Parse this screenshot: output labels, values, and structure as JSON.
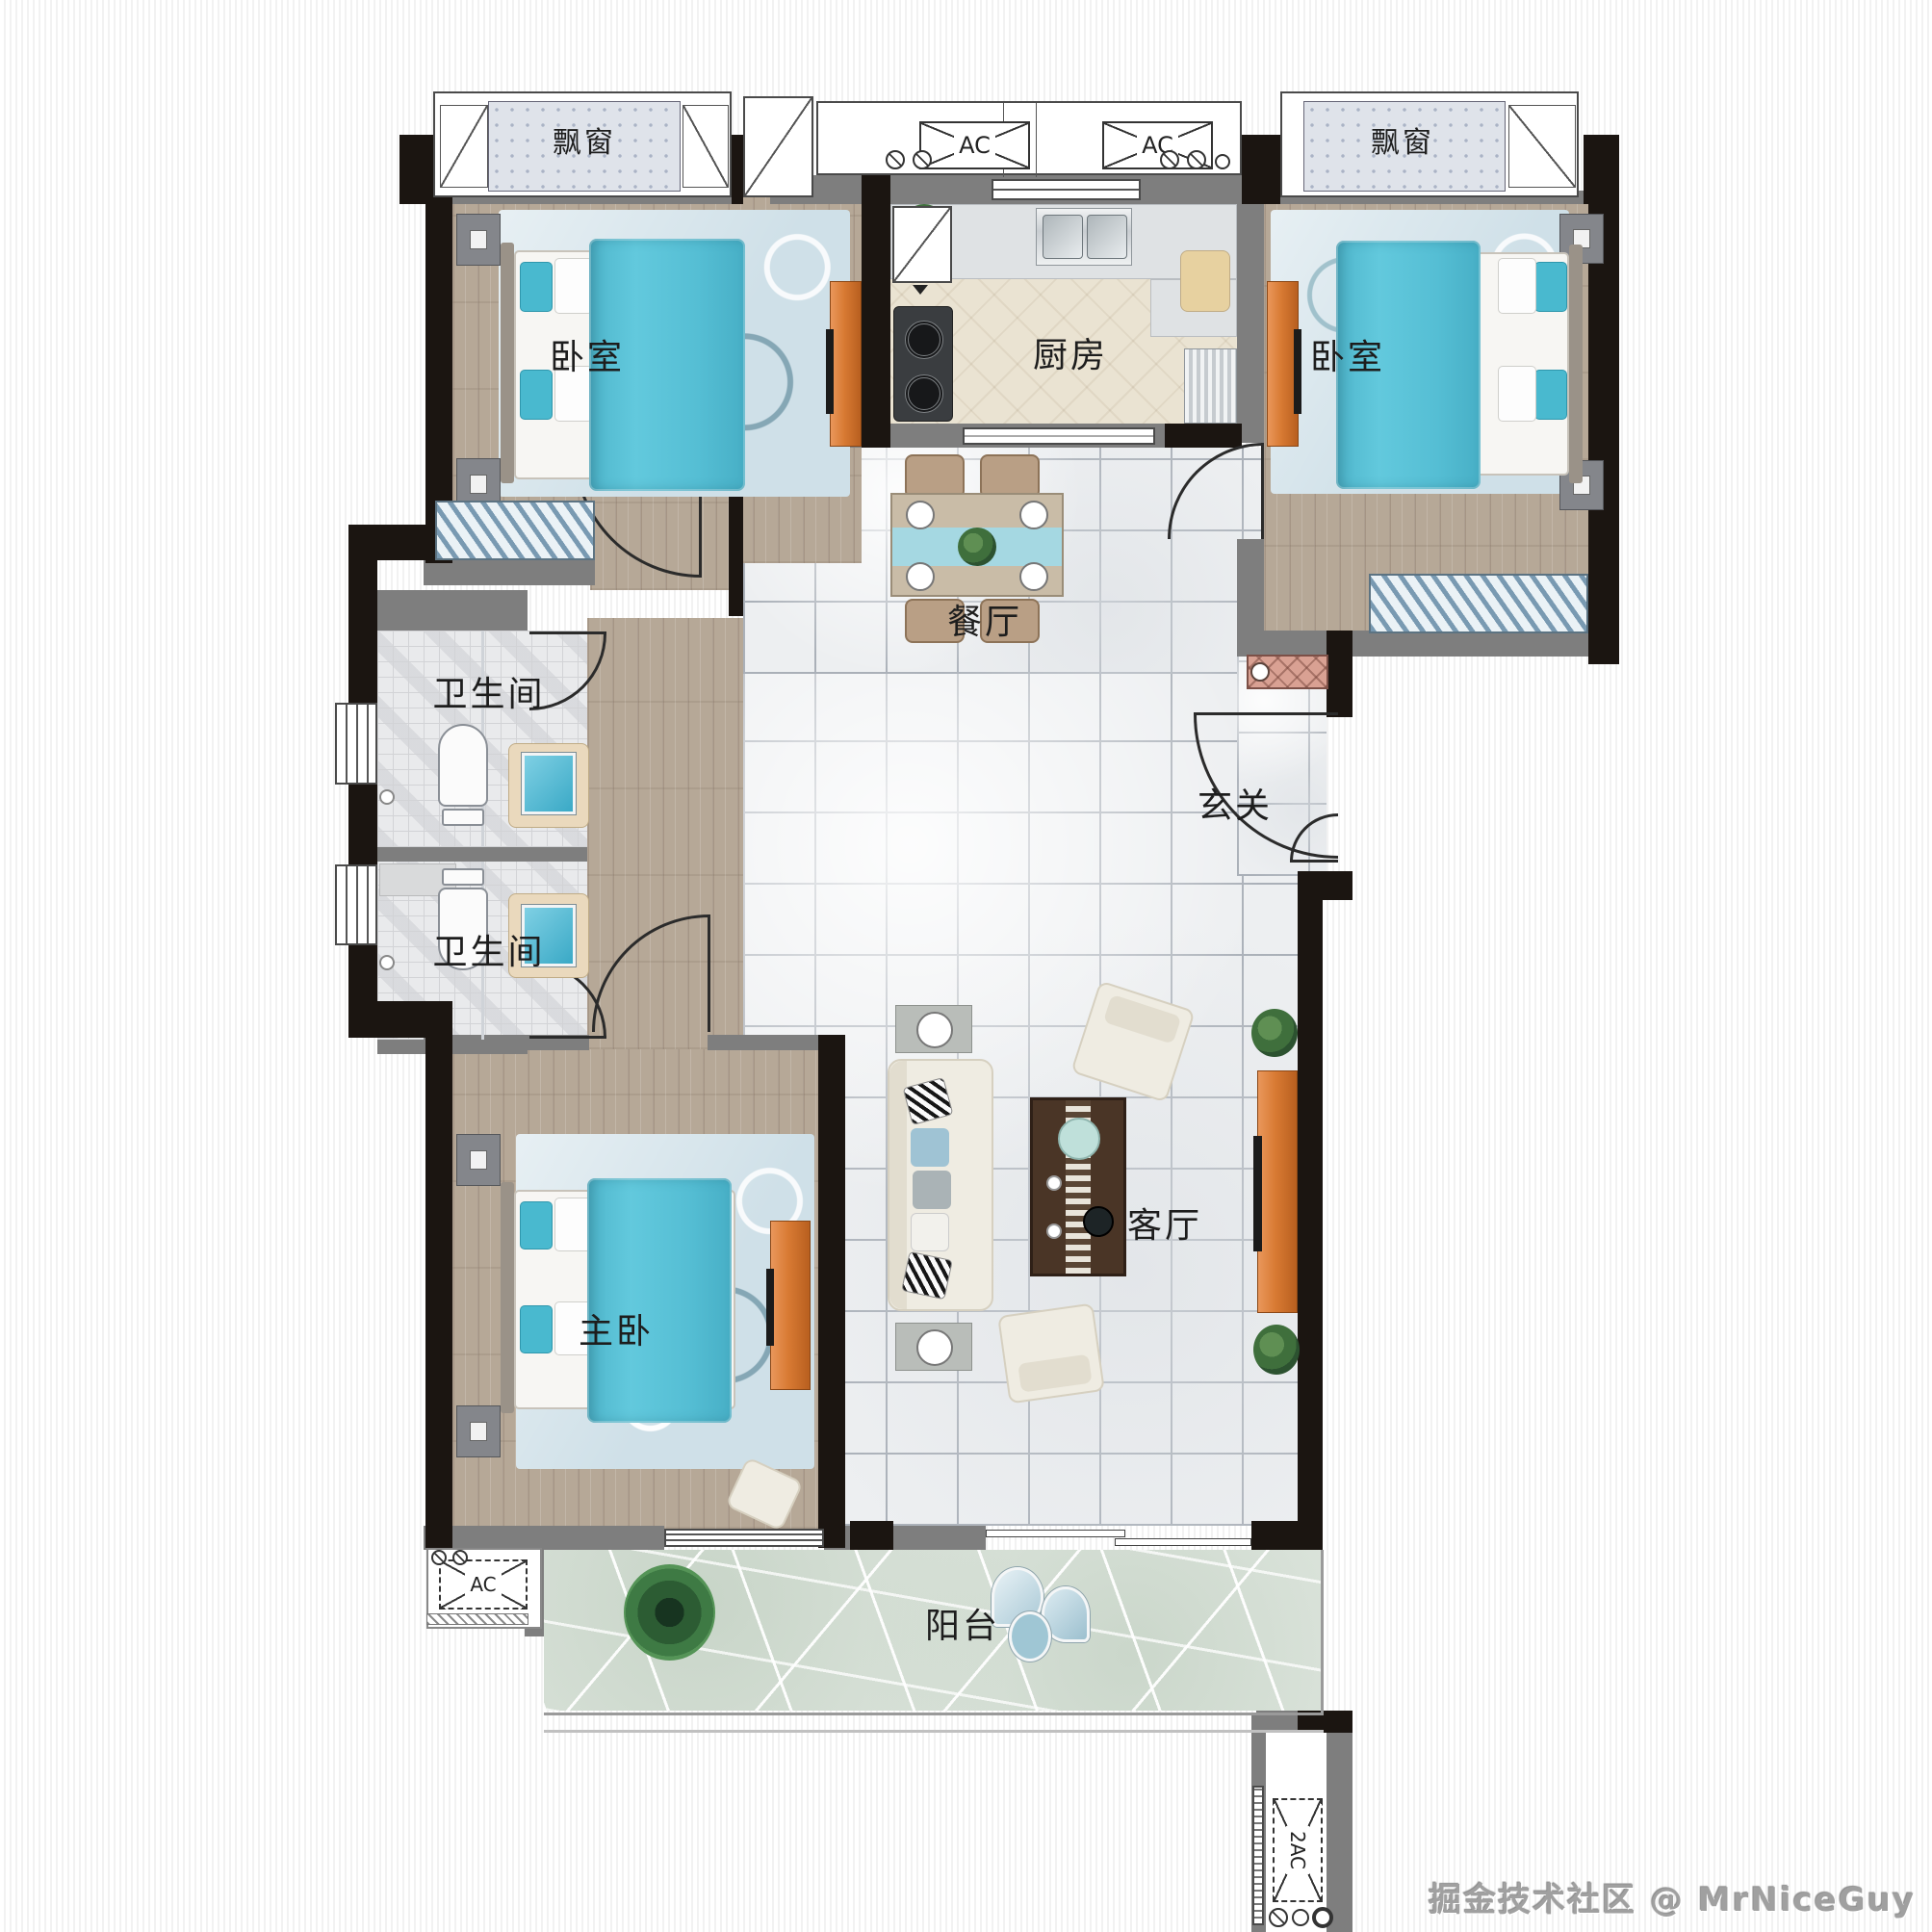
{
  "labels": {
    "bedroom1": "卧室",
    "bedroom2": "卧室",
    "master": "主卧",
    "kitchen": "厨房",
    "dining": "餐厅",
    "living": "客厅",
    "entry": "玄关",
    "bath1": "卫生间",
    "bath2": "卫生间",
    "balcony": "阳台",
    "bay1": "飘窗",
    "bay2": "飘窗",
    "ac_left": "AC",
    "ac_right": "AC",
    "ac_balcony": "AC",
    "ac_shaft": "2AC",
    "watermark": "掘金技术社区 @ MrNiceGuy"
  },
  "colors": {
    "wall_black": "#1b1511",
    "wall_gray": "#7e7e7e",
    "accent_teal": "#58c3d8",
    "cabinet_orange": "#d87a33",
    "rug_blue": "#cfe0e8",
    "stone_green": "#dde5dd",
    "shoe_cabinet_pink": "#d9a193"
  }
}
